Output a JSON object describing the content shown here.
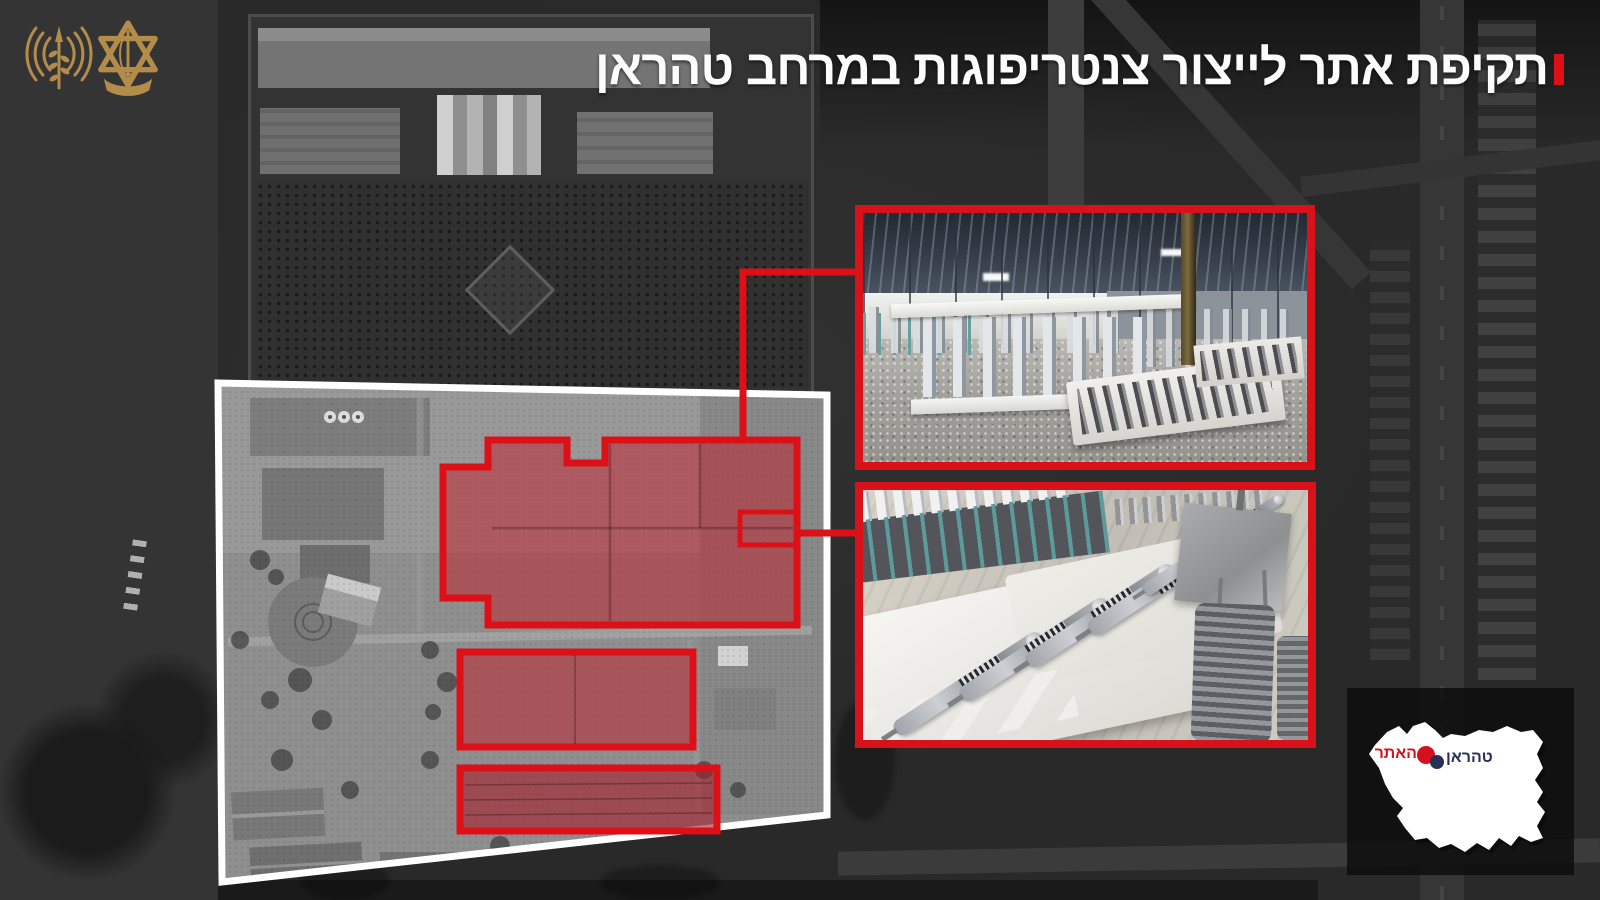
{
  "header": {
    "title": "תקיפת אתר לייצור צנטריפוגות במרחב טהראן",
    "accent_color": "#dd1018",
    "logos": [
      {
        "name": "idf-spokesperson-emblem",
        "color": "#b38c4a"
      },
      {
        "name": "idf-emblem",
        "color": "#b38c4a"
      }
    ]
  },
  "annotation": {
    "frame_red": "#dd1018",
    "overview_frame_white": "#ffffff",
    "building_highlight_fill": "rgba(191,38,51,0.55)",
    "highlighted_building_count": 3,
    "photo_insets": 2
  },
  "map_card": {
    "background": "#0c0c0c",
    "country_shape": "iran-silhouette",
    "labels": {
      "city": {
        "text": "טהראן",
        "color": "#273158"
      },
      "site": {
        "text": "האתר",
        "color": "#d6101c"
      }
    }
  }
}
